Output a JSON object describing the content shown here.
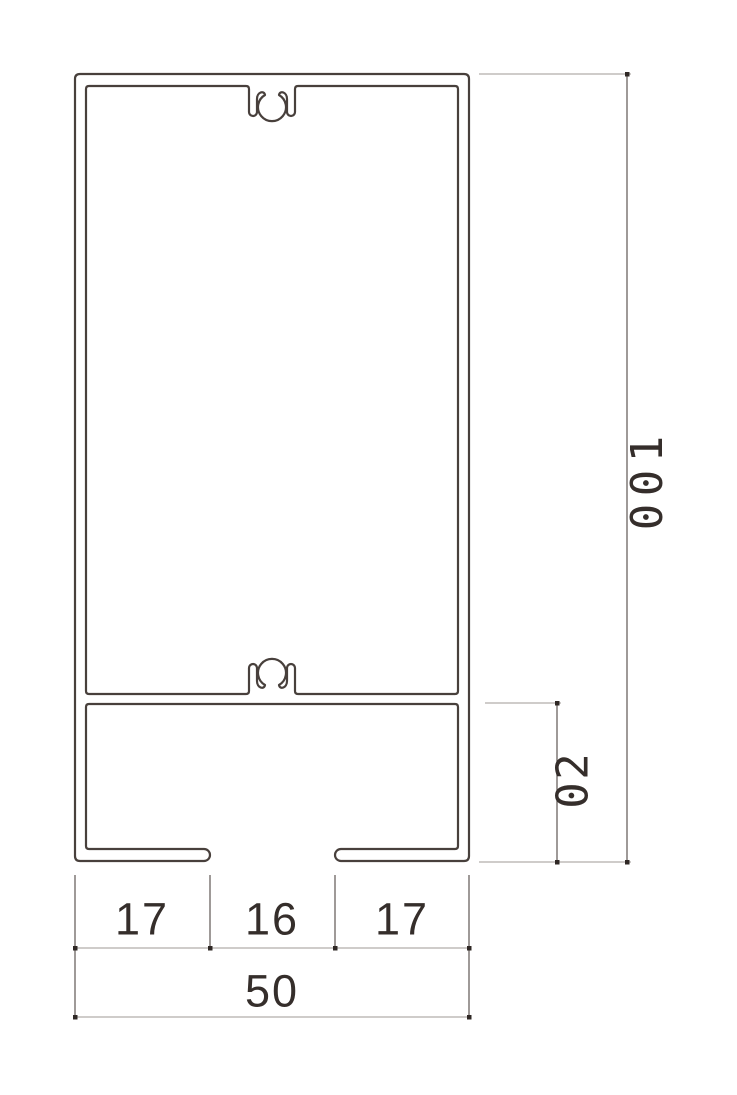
{
  "drawing": {
    "dimensions": {
      "overall_height": "100",
      "lower_section_height": "20",
      "bottom_left_flange": "17",
      "bottom_slot": "16",
      "bottom_right_flange": "17",
      "overall_width": "50"
    },
    "colors": {
      "background": "#ffffff",
      "profile_stroke": "#48403c",
      "extension_line": "#6b6360",
      "dimension_line": "#b2adaa",
      "end_marker": "#2f2825",
      "text": "#352e2b"
    }
  }
}
